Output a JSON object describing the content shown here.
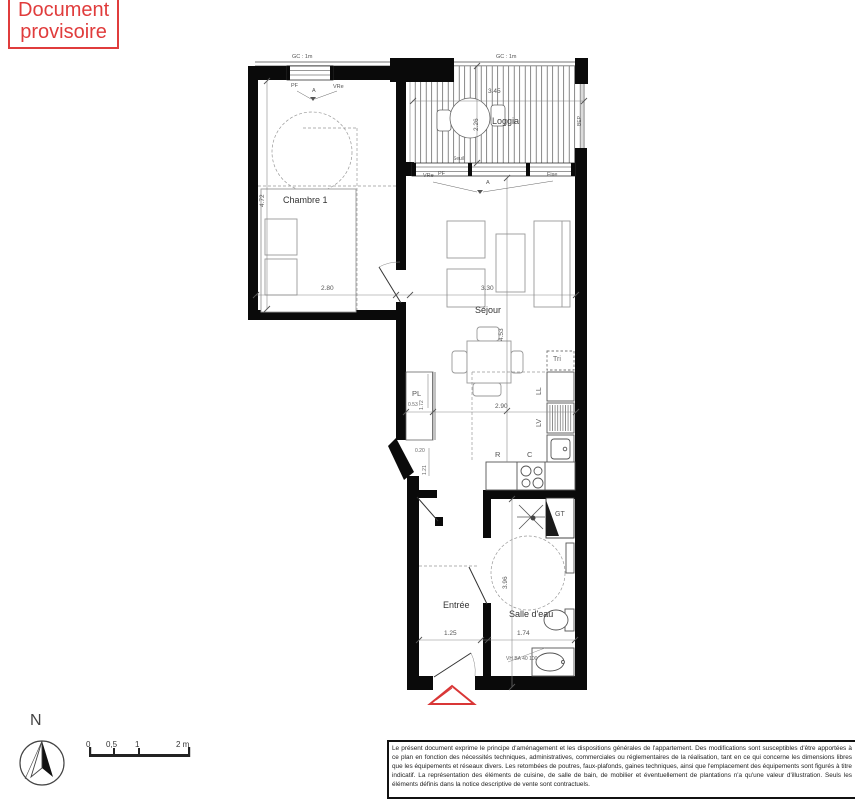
{
  "banner": {
    "line1": "Document",
    "line2": "provisoire"
  },
  "labels": {
    "chambre": "Chambre 1",
    "loggia": "Loggia",
    "sejour": "Séjour",
    "entree": "Entrée",
    "salle_eau": "Salle d'eau",
    "pl": "PL",
    "tri": "Tri",
    "ll": "LL",
    "lv": "LV",
    "refrigerateur": "R",
    "cuisson": "C",
    "gt": "GT",
    "seuil": "Seuil",
    "rail": "BEP"
  },
  "dims": {
    "chambre_w": "2.80",
    "chambre_h": "4.72",
    "sejour_w": "3.30",
    "sejour_h": "4.53",
    "loggia_w": "3.45",
    "loggia_h": "2.26",
    "cuisine_w": "2.90",
    "pl_w": "0.53",
    "pl_h": "1.72",
    "hall_w": "0.20",
    "hall_h": "1.21",
    "entree_w": "1.25",
    "salle_eau_w": "1.74",
    "salle_eau_h": "3.96"
  },
  "tags": {
    "gc_left": "GC : 1m",
    "gc_right": "GC : 1m",
    "chambre_pf": "PF",
    "chambre_axis": "A",
    "chambre_vr": "VRe",
    "sejour_vr": "VRe",
    "sejour_pf": "PF",
    "sejour_axis": "A",
    "sejour_fixe": "Fixe",
    "vmc": "VH BA 40 100"
  },
  "compass": {
    "north": "N"
  },
  "scale": {
    "t0": "0",
    "t05": "0,5",
    "t1": "1",
    "t2": "2 m"
  },
  "disclaimer": {
    "text": "Le présent document exprime le principe d'aménagement et les dispositions générales de l'appartement. Des modifications sont susceptibles d'être apportées à ce plan en fonction des nécessités techniques, administratives, commerciales ou réglementaires de la réalisation, tant en ce qui concerne les dimensions libres que les équipements et réseaux divers. Les retombées de poutres, faux-plafonds, gaines techniques, ainsi que l'emplacement des équipements sont figurés à titre indicatif. La représentation des éléments de cuisine, de salle de bain, de mobilier et éventuellement de plantations n'a qu'une valeur d'illustration. Seuls les éléments définis dans la notice descriptive de vente sont contractuels."
  },
  "colors": {
    "accent_red": "#e03c3c"
  }
}
